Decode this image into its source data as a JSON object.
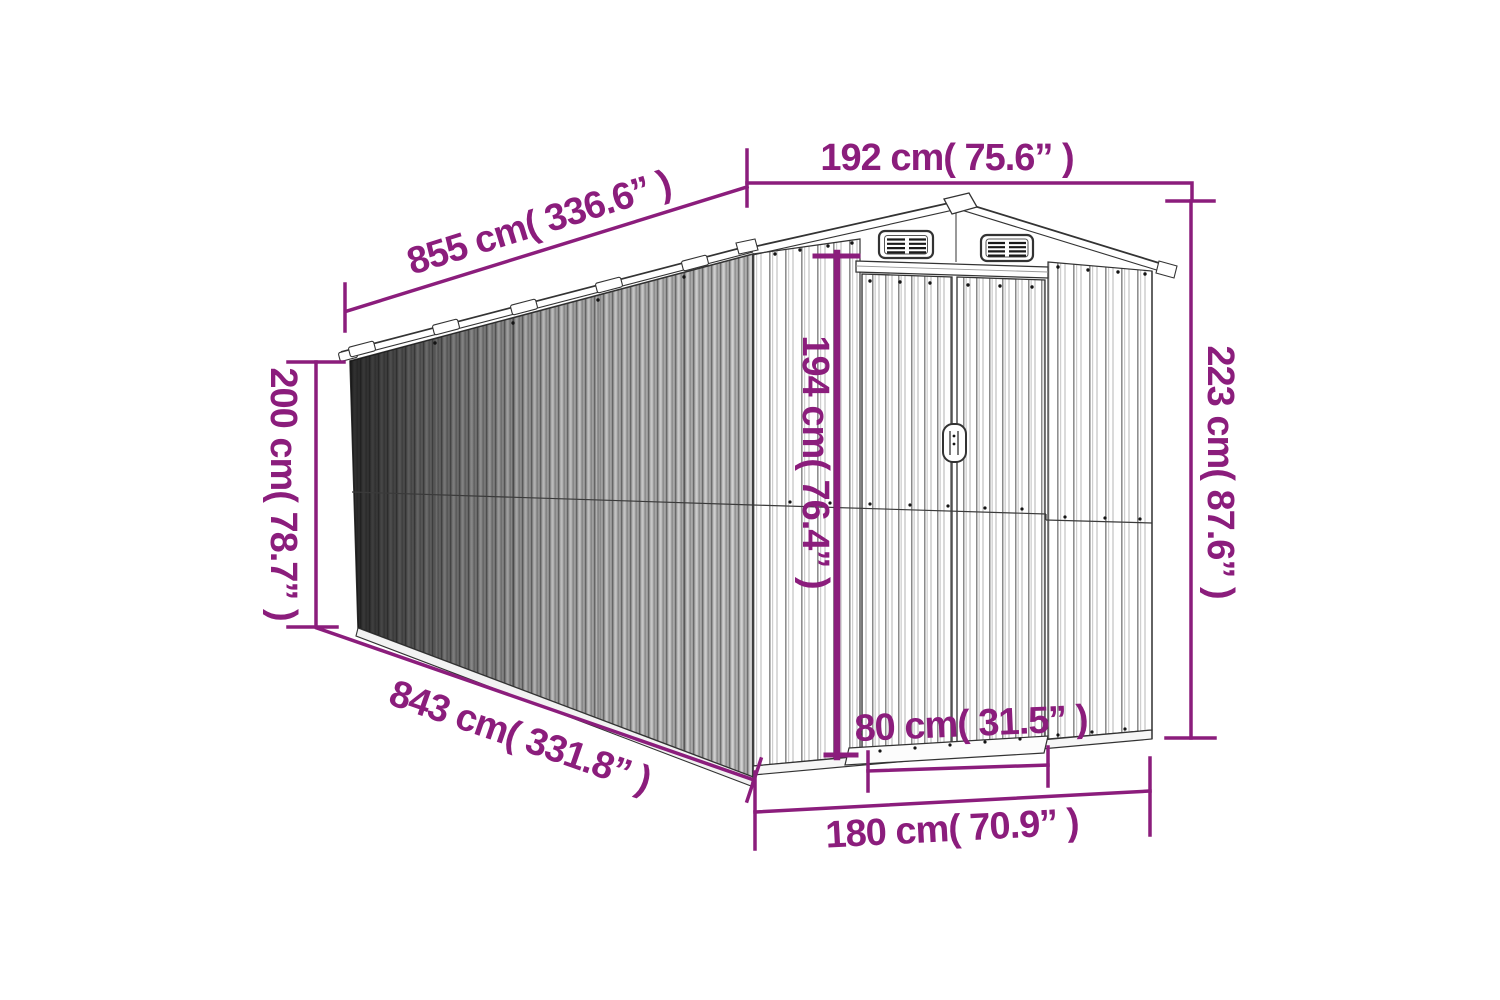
{
  "diagram": {
    "type": "product-dimension-diagram",
    "subject": "metal-garden-shed-line-drawing",
    "accent_color": "#8b1d7c",
    "drawing_color": "#333333",
    "dimensions": {
      "roof_length": "855 cm( 336.6” )",
      "roof_width": "192 cm( 75.6” )",
      "total_height": "223 cm( 87.6” )",
      "wall_height": "200 cm( 78.7” )",
      "door_height": "194 cm( 76.4” )",
      "base_length": "843 cm( 331.8” )",
      "door_width": "80 cm( 31.5” )",
      "base_width": "180 cm( 70.9” )"
    }
  }
}
